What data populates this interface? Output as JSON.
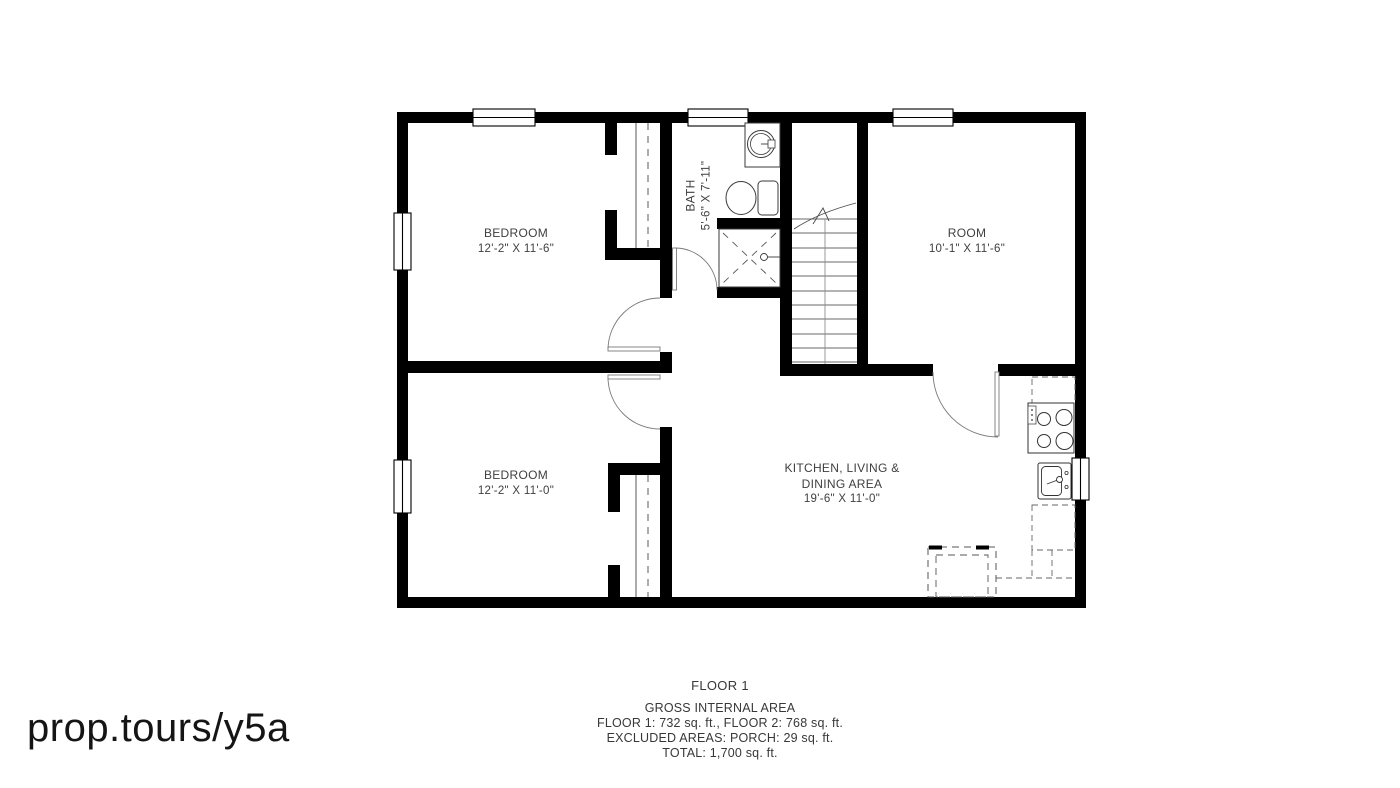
{
  "watermark": {
    "text": "prop.tours/y5a"
  },
  "plan": {
    "rooms": {
      "bedroom_top": {
        "name": "BEDROOM",
        "dims": "12'-2\" X 11'-6\""
      },
      "bedroom_bottom": {
        "name": "BEDROOM",
        "dims": "12'-2\" X 11'-0\""
      },
      "bath": {
        "name": "BATH",
        "dims": "5'-6\" X 7'-11\""
      },
      "room": {
        "name": "ROOM",
        "dims": "10'-1\" X 11'-6\""
      },
      "kitchen": {
        "name_line1": "KITCHEN, LIVING &",
        "name_line2": "DINING AREA",
        "dims": "19'-6\" X 11'-0\""
      }
    }
  },
  "footer": {
    "floor_title": "FLOOR 1",
    "gross_area_label": "GROSS INTERNAL AREA",
    "floor_areas": "FLOOR 1: 732 sq. ft., FLOOR 2: 768 sq. ft.",
    "excluded_areas": "EXCLUDED AREAS: PORCH: 29 sq. ft.",
    "total_area": "TOTAL: 1,700 sq. ft."
  },
  "colors": {
    "wall": "#000000",
    "fixture_line": "#4a4a4a",
    "label_text": "#3f3f3f",
    "background": "#ffffff"
  }
}
